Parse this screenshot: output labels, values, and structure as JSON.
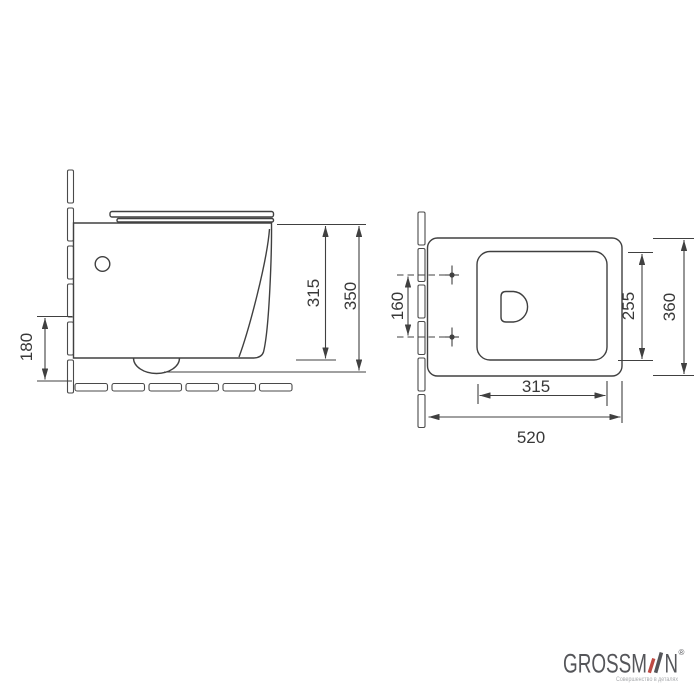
{
  "drawing": {
    "line_color": "#404040",
    "side_view": {
      "drain_height": "180",
      "rim_height": "315",
      "overall_height": "350"
    },
    "top_view": {
      "hole_spacing": "160",
      "bowl_depth": "255",
      "overall_depth": "360",
      "bowl_width": "315",
      "overall_width": "520"
    }
  },
  "logo": {
    "brand_before_a": "GROSSM",
    "brand_after_a": "N",
    "registered": "®",
    "tagline": "Совершенство в деталях",
    "brand_color": "#55565a",
    "accent_color": "#bf4a43"
  }
}
